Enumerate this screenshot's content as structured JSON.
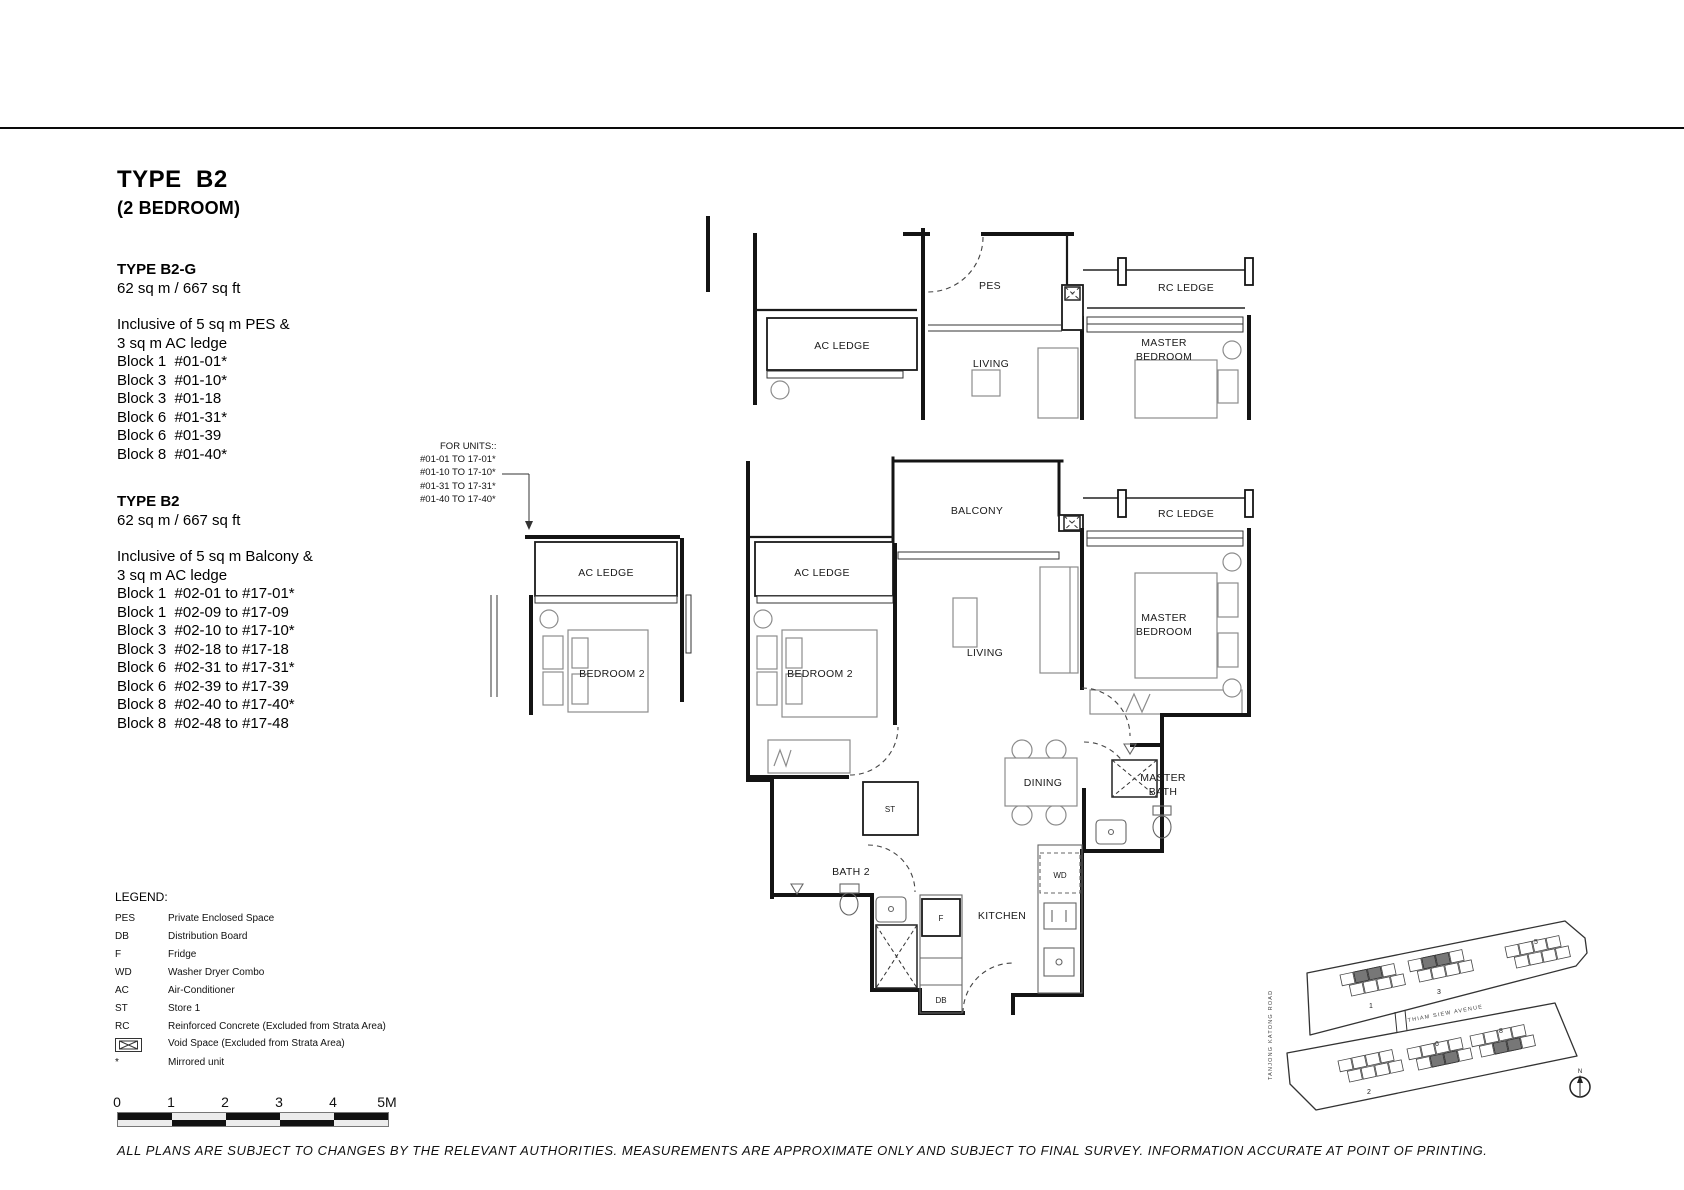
{
  "header": {
    "title": "TYPE  B2",
    "subtitle": "(2 BEDROOM)"
  },
  "specs": [
    {
      "name": "TYPE B2-G",
      "area": "62 sq m / 667 sq ft",
      "inclusive_1": "Inclusive of 5 sq m PES &",
      "inclusive_2": "3 sq m AC ledge",
      "units": [
        "Block 1  #01-01*",
        "Block 3  #01-10*",
        "Block 3  #01-18",
        "Block 6  #01-31*",
        "Block 6  #01-39",
        "Block 8  #01-40*"
      ]
    },
    {
      "name": "TYPE B2",
      "area": "62 sq m / 667 sq ft",
      "inclusive_1": "Inclusive of 5 sq m Balcony &",
      "inclusive_2": "3 sq m AC ledge",
      "units": [
        "Block 1  #02-01 to #17-01*",
        "Block 1  #02-09 to #17-09",
        "Block 3  #02-10 to #17-10*",
        "Block 3  #02-18 to #17-18",
        "Block 6  #02-31 to #17-31*",
        "Block 6  #02-39 to #17-39",
        "Block 8  #02-40 to #17-40*",
        "Block 8  #02-48 to #17-48"
      ]
    }
  ],
  "for_units": {
    "heading": "FOR UNITS::",
    "lines": [
      "#01-01 TO 17-01*",
      "#01-10 TO 17-10*",
      "#01-31 TO 17-31*",
      "#01-40 TO 17-40*"
    ]
  },
  "floorplan": {
    "rooms": {
      "pes": "PES",
      "ac_ledge": "AC LEDGE",
      "rc_ledge": "RC LEDGE",
      "living": "LIVING",
      "master_line1": "MASTER",
      "master_line2": "BEDROOM",
      "bath_line2": "BATH",
      "balcony": "BALCONY",
      "bedroom2": "BEDROOM 2",
      "dining": "DINING",
      "bath2": "BATH 2",
      "kitchen": "KITCHEN"
    },
    "fixtures": {
      "st": "ST",
      "wd": "WD",
      "fridge": "F",
      "db": "DB"
    }
  },
  "legend": {
    "heading": "LEGEND:",
    "items": [
      {
        "key": "PES",
        "value": "Private Enclosed Space"
      },
      {
        "key": "DB",
        "value": "Distribution Board"
      },
      {
        "key": "F",
        "value": "Fridge"
      },
      {
        "key": "WD",
        "value": "Washer Dryer Combo"
      },
      {
        "key": "AC",
        "value": "Air-Conditioner"
      },
      {
        "key": "ST",
        "value": "Store 1"
      },
      {
        "key": "RC",
        "value": "Reinforced Concrete (Excluded from Strata Area)"
      },
      {
        "key": "",
        "value": "Void Space (Excluded from Strata Area)"
      },
      {
        "key": "*",
        "value": "Mirrored unit"
      }
    ]
  },
  "scalebar": {
    "labels": [
      "0",
      "1",
      "2",
      "3",
      "4",
      "5M"
    ]
  },
  "siteplan": {
    "road_vertical": "TANJONG   KATONG   ROAD",
    "road_avenue": "THIAM    SIEW    AVENUE",
    "blocks": [
      "1",
      "3",
      "5",
      "2",
      "6",
      "8"
    ],
    "north": "N"
  },
  "disclaimer": "ALL PLANS ARE SUBJECT TO CHANGES BY THE RELEVANT AUTHORITIES. MEASUREMENTS ARE APPROXIMATE ONLY AND SUBJECT TO FINAL SURVEY. INFORMATION ACCURATE AT POINT OF PRINTING."
}
